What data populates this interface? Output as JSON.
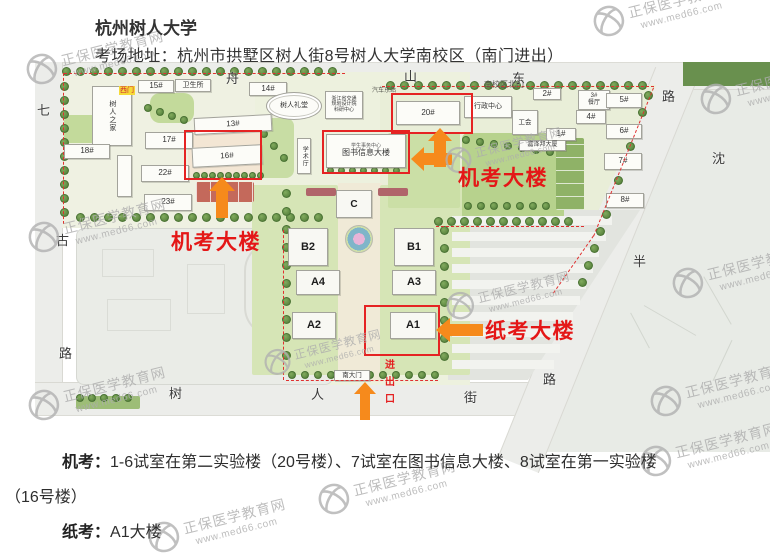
{
  "header": {
    "title": "杭州树人大学",
    "address": "考场地址：杭州市拱墅区树人街8号树人大学南校区（南门进出）"
  },
  "notes": {
    "machine_label": "机考：",
    "machine_text": "1-6试室在第二实验楼（20号楼）、7试室在图书信息大楼、8试室在第一实验楼（16号楼）",
    "paper_label": "纸考：",
    "paper_text": "A1大楼"
  },
  "watermark": {
    "name": "正保医学教育网",
    "url": "www.med66.com",
    "color": "#adadad",
    "positions": [
      {
        "x": 593,
        "y": 8
      },
      {
        "x": 26,
        "y": 56
      },
      {
        "x": 700,
        "y": 86
      },
      {
        "x": 28,
        "y": 224
      },
      {
        "x": 672,
        "y": 270
      },
      {
        "x": 264,
        "y": 348,
        "s": 0.85
      },
      {
        "x": 446,
        "y": 292,
        "s": 0.9
      },
      {
        "x": 28,
        "y": 392
      },
      {
        "x": 650,
        "y": 388
      },
      {
        "x": 640,
        "y": 448
      },
      {
        "x": 318,
        "y": 486
      },
      {
        "x": 148,
        "y": 524
      },
      {
        "x": 445,
        "y": 146,
        "s": 0.85
      }
    ]
  },
  "map": {
    "colors": {
      "arrow": "#f68a1c",
      "red_box": "#e52323",
      "red_label": "#e41717",
      "tree": "#4d7935"
    },
    "exam_labels": [
      {
        "t": "机考大楼",
        "x": 171,
        "y": 226
      },
      {
        "t": "机考大楼",
        "x": 458,
        "y": 162
      },
      {
        "t": "纸考大楼",
        "x": 485,
        "y": 315
      }
    ],
    "entrance_chars": [
      {
        "t": "进",
        "x": 385,
        "y": 356
      },
      {
        "t": "出",
        "x": 385,
        "y": 373
      },
      {
        "t": "口",
        "x": 385,
        "y": 390
      }
    ],
    "gate_badge": {
      "t": "西门",
      "x": 119,
      "y": 86
    },
    "street_labels": [
      {
        "t": "舟",
        "x": 226,
        "y": 68
      },
      {
        "t": "山",
        "x": 404,
        "y": 66
      },
      {
        "t": "东",
        "x": 512,
        "y": 68
      },
      {
        "t": "路",
        "x": 662,
        "y": 86
      },
      {
        "t": "沈",
        "x": 712,
        "y": 148
      },
      {
        "t": "半",
        "x": 633,
        "y": 251
      },
      {
        "t": "路",
        "x": 543,
        "y": 369
      },
      {
        "t": "七",
        "x": 37,
        "y": 100
      },
      {
        "t": "古",
        "x": 56,
        "y": 230
      },
      {
        "t": "路",
        "x": 59,
        "y": 343
      },
      {
        "t": "树",
        "x": 169,
        "y": 383
      },
      {
        "t": "人",
        "x": 311,
        "y": 384
      },
      {
        "t": "街",
        "x": 464,
        "y": 387
      }
    ],
    "tiny_labels": [
      {
        "t": "南校区北门",
        "x": 484,
        "y": 79,
        "fs": 8
      },
      {
        "t": "汽车东站",
        "x": 372,
        "y": 85,
        "fs": 6
      }
    ],
    "buildings": [
      {
        "l": "树人之家",
        "x": 92,
        "y": 86,
        "w": 40,
        "h": 60,
        "cls": "vert",
        "fs": 7
      },
      {
        "l": "15#",
        "x": 138,
        "y": 80,
        "w": 36,
        "h": 13
      },
      {
        "l": "卫生所",
        "x": 175,
        "y": 79,
        "w": 36,
        "h": 13,
        "fs": 7
      },
      {
        "l": "14#",
        "x": 249,
        "y": 82,
        "w": 38,
        "h": 14
      },
      {
        "l": "13#",
        "x": 194,
        "y": 116,
        "w": 78,
        "h": 17,
        "rot": -3
      },
      {
        "l": "17#",
        "x": 145,
        "y": 132,
        "w": 48,
        "h": 17
      },
      {
        "l": "18#",
        "x": 64,
        "y": 144,
        "w": 46,
        "h": 15
      },
      {
        "l": "16#",
        "x": 192,
        "y": 146,
        "w": 70,
        "h": 20,
        "rot": -3
      },
      {
        "l": "22#",
        "x": 141,
        "y": 165,
        "w": 48,
        "h": 17
      },
      {
        "l": "23#",
        "x": 144,
        "y": 194,
        "w": 48,
        "h": 17
      },
      {
        "l": "",
        "x": 117,
        "y": 155,
        "w": 15,
        "h": 42
      },
      {
        "l": "树人礼堂",
        "x": 266,
        "y": 92,
        "w": 56,
        "h": 28,
        "cls": "hall",
        "fs": 7
      },
      {
        "l": "浙江省交通\n规划设计院\n科研中心",
        "x": 325,
        "y": 91,
        "w": 38,
        "h": 28,
        "fs": 5
      },
      {
        "l": "行政中心",
        "x": 464,
        "y": 96,
        "w": 48,
        "h": 22,
        "fs": 7
      },
      {
        "l": "学术厅",
        "x": 297,
        "y": 138,
        "w": 14,
        "h": 36,
        "cls": "vert",
        "fs": 6
      },
      {
        "l": "图书信息大楼",
        "x": 326,
        "y": 134,
        "w": 80,
        "h": 34,
        "sub": "学生事务中心",
        "fs": 8
      },
      {
        "l": "C",
        "x": 336,
        "y": 190,
        "w": 36,
        "h": 28,
        "cls": "big",
        "fs": 10
      },
      {
        "l": "B2",
        "x": 288,
        "y": 228,
        "w": 40,
        "h": 38,
        "cls": "big",
        "fs": 11
      },
      {
        "l": "B1",
        "x": 394,
        "y": 228,
        "w": 40,
        "h": 38,
        "cls": "big",
        "fs": 11
      },
      {
        "l": "A4",
        "x": 296,
        "y": 270,
        "w": 44,
        "h": 25,
        "cls": "big",
        "fs": 11
      },
      {
        "l": "A3",
        "x": 392,
        "y": 270,
        "w": 44,
        "h": 25,
        "cls": "big",
        "fs": 11
      },
      {
        "l": "A2",
        "x": 292,
        "y": 312,
        "w": 44,
        "h": 27,
        "cls": "big",
        "fs": 11
      },
      {
        "l": "A1",
        "x": 390,
        "y": 312,
        "w": 46,
        "h": 27,
        "cls": "big",
        "fs": 11
      },
      {
        "l": "20#",
        "x": 396,
        "y": 101,
        "w": 64,
        "h": 24
      },
      {
        "l": "工会",
        "x": 512,
        "y": 110,
        "w": 26,
        "h": 25,
        "fs": 6.5
      },
      {
        "l": "1#",
        "x": 546,
        "y": 128,
        "w": 30,
        "h": 13
      },
      {
        "l": "嘉泽邦大厦",
        "x": 519,
        "y": 140,
        "w": 47,
        "h": 11,
        "fs": 6
      },
      {
        "l": "2#",
        "x": 533,
        "y": 88,
        "w": 28,
        "h": 12
      },
      {
        "l": "3#\n餐厅",
        "x": 578,
        "y": 90,
        "w": 32,
        "h": 20,
        "fs": 6
      },
      {
        "l": "5#",
        "x": 606,
        "y": 93,
        "w": 36,
        "h": 15
      },
      {
        "l": "4#",
        "x": 576,
        "y": 110,
        "w": 30,
        "h": 14
      },
      {
        "l": "6#",
        "x": 606,
        "y": 124,
        "w": 36,
        "h": 15
      },
      {
        "l": "7#",
        "x": 604,
        "y": 153,
        "w": 38,
        "h": 17
      },
      {
        "l": "8#",
        "x": 606,
        "y": 193,
        "w": 38,
        "h": 15
      },
      {
        "l": "南大门",
        "x": 334,
        "y": 370,
        "w": 36,
        "h": 11,
        "fs": 6.5
      }
    ],
    "lawns": [
      {
        "x": 252,
        "y": 185,
        "w": 86,
        "h": 190,
        "c": "#d6e5b6"
      },
      {
        "x": 380,
        "y": 185,
        "w": 90,
        "h": 190,
        "c": "#d6e5b6"
      },
      {
        "x": 462,
        "y": 133,
        "w": 102,
        "h": 88,
        "c": "#b7d28d",
        "r": 6
      },
      {
        "x": 388,
        "y": 133,
        "w": 72,
        "h": 75,
        "c": "#cbdfa6"
      },
      {
        "x": 150,
        "y": 93,
        "w": 44,
        "h": 30,
        "c": "#c3da9b",
        "r": 10
      },
      {
        "x": 64,
        "y": 115,
        "w": 56,
        "h": 28,
        "c": "#c3da9b",
        "r": 6
      },
      {
        "x": 248,
        "y": 118,
        "w": 46,
        "h": 60,
        "c": "#c8dda4",
        "r": 8
      },
      {
        "x": 188,
        "y": 132,
        "w": 74,
        "h": 47,
        "c": "#f3e6d4"
      },
      {
        "x": 196,
        "y": 182,
        "w": 58,
        "h": 20,
        "c": "#c4695b",
        "stripe": "v"
      },
      {
        "x": 556,
        "y": 138,
        "w": 28,
        "h": 72,
        "c": "#8fb267",
        "stripe": "h"
      },
      {
        "x": 76,
        "y": 396,
        "w": 64,
        "h": 13,
        "c": "#9dbd77"
      },
      {
        "x": 306,
        "y": 188,
        "w": 30,
        "h": 8,
        "c": "#b0656a"
      },
      {
        "x": 378,
        "y": 188,
        "w": 30,
        "h": 8,
        "c": "#b0656a"
      }
    ],
    "tree_rows": [
      {
        "x": 66,
        "y": 71,
        "n": 20,
        "dx": 14,
        "dy": 0
      },
      {
        "x": 64,
        "y": 86,
        "n": 10,
        "dx": 0,
        "dy": 14
      },
      {
        "x": 80,
        "y": 217,
        "n": 18,
        "dx": 14,
        "dy": 0
      },
      {
        "x": 196,
        "y": 175,
        "n": 9,
        "dx": 8,
        "dy": 0,
        "s": 7
      },
      {
        "x": 390,
        "y": 85,
        "n": 19,
        "dx": 14,
        "dy": 0
      },
      {
        "x": 648,
        "y": 95,
        "n": 12,
        "dx": -6,
        "dy": 17
      },
      {
        "x": 438,
        "y": 221,
        "n": 11,
        "dx": 13,
        "dy": 0
      },
      {
        "x": 292,
        "y": 375,
        "n": 12,
        "dx": 13,
        "dy": 0,
        "s": 8
      },
      {
        "x": 286,
        "y": 193,
        "n": 10,
        "dx": 0,
        "dy": 18
      },
      {
        "x": 444,
        "y": 230,
        "n": 8,
        "dx": 0,
        "dy": 18
      },
      {
        "x": 80,
        "y": 398,
        "n": 5,
        "dx": 12,
        "dy": 0,
        "s": 8
      },
      {
        "x": 466,
        "y": 140,
        "n": 7,
        "dx": 14,
        "dy": 2,
        "s": 8
      },
      {
        "x": 468,
        "y": 206,
        "n": 7,
        "dx": 13,
        "dy": 0,
        "s": 8
      },
      {
        "x": 330,
        "y": 170,
        "n": 7,
        "dx": 11,
        "dy": 0,
        "s": 7
      },
      {
        "x": 254,
        "y": 122,
        "n": 4,
        "dx": 10,
        "dy": 12,
        "s": 8
      },
      {
        "x": 148,
        "y": 108,
        "n": 4,
        "dx": 12,
        "dy": 4,
        "s": 8
      }
    ],
    "red_dashes": [
      {
        "x": 64,
        "y": 73,
        "len": 281,
        "rot": 0
      },
      {
        "x": 64,
        "y": 73,
        "len": 151,
        "rot": 90
      },
      {
        "x": 382,
        "y": 86,
        "len": 272,
        "rot": 0
      },
      {
        "x": 654,
        "y": 88,
        "len": 160,
        "rot": 112
      },
      {
        "x": 286,
        "y": 380,
        "len": 152,
        "rot": 0
      },
      {
        "x": 436,
        "y": 226,
        "len": 148,
        "rot": 0
      },
      {
        "x": 594,
        "y": 236,
        "len": 70,
        "rot": 125
      },
      {
        "x": 284,
        "y": 230,
        "len": 150,
        "rot": 90
      }
    ],
    "red_boxes": [
      {
        "x": 184,
        "y": 130,
        "w": 78,
        "h": 50
      },
      {
        "x": 322,
        "y": 130,
        "w": 88,
        "h": 44
      },
      {
        "x": 391,
        "y": 93,
        "w": 82,
        "h": 41
      },
      {
        "x": 364,
        "y": 305,
        "w": 76,
        "h": 51
      }
    ],
    "arrows": [
      {
        "type": "up",
        "tipx": 222,
        "tipy": 177,
        "hw": 26,
        "hh": 14,
        "sw": 12,
        "slen": 27
      },
      {
        "type": "up",
        "tipx": 440,
        "tipy": 128,
        "hw": 24,
        "hh": 13,
        "sw": 12,
        "slen": 26
      },
      {
        "type": "left",
        "tipx": 411,
        "tipy": 159,
        "hw": 13,
        "hh": 24,
        "sw": 12,
        "slen": 28
      },
      {
        "type": "left",
        "tipx": 436,
        "tipy": 330,
        "hw": 14,
        "hh": 24,
        "sw": 12,
        "slen": 33
      },
      {
        "type": "up",
        "tipx": 365,
        "tipy": 382,
        "hw": 22,
        "hh": 12,
        "sw": 10,
        "slen": 26
      }
    ],
    "parking_bars": {
      "x": 452,
      "y": 216,
      "rows": 10,
      "gap": 16,
      "h": 9,
      "w0": 160,
      "dw": 6.5
    }
  }
}
